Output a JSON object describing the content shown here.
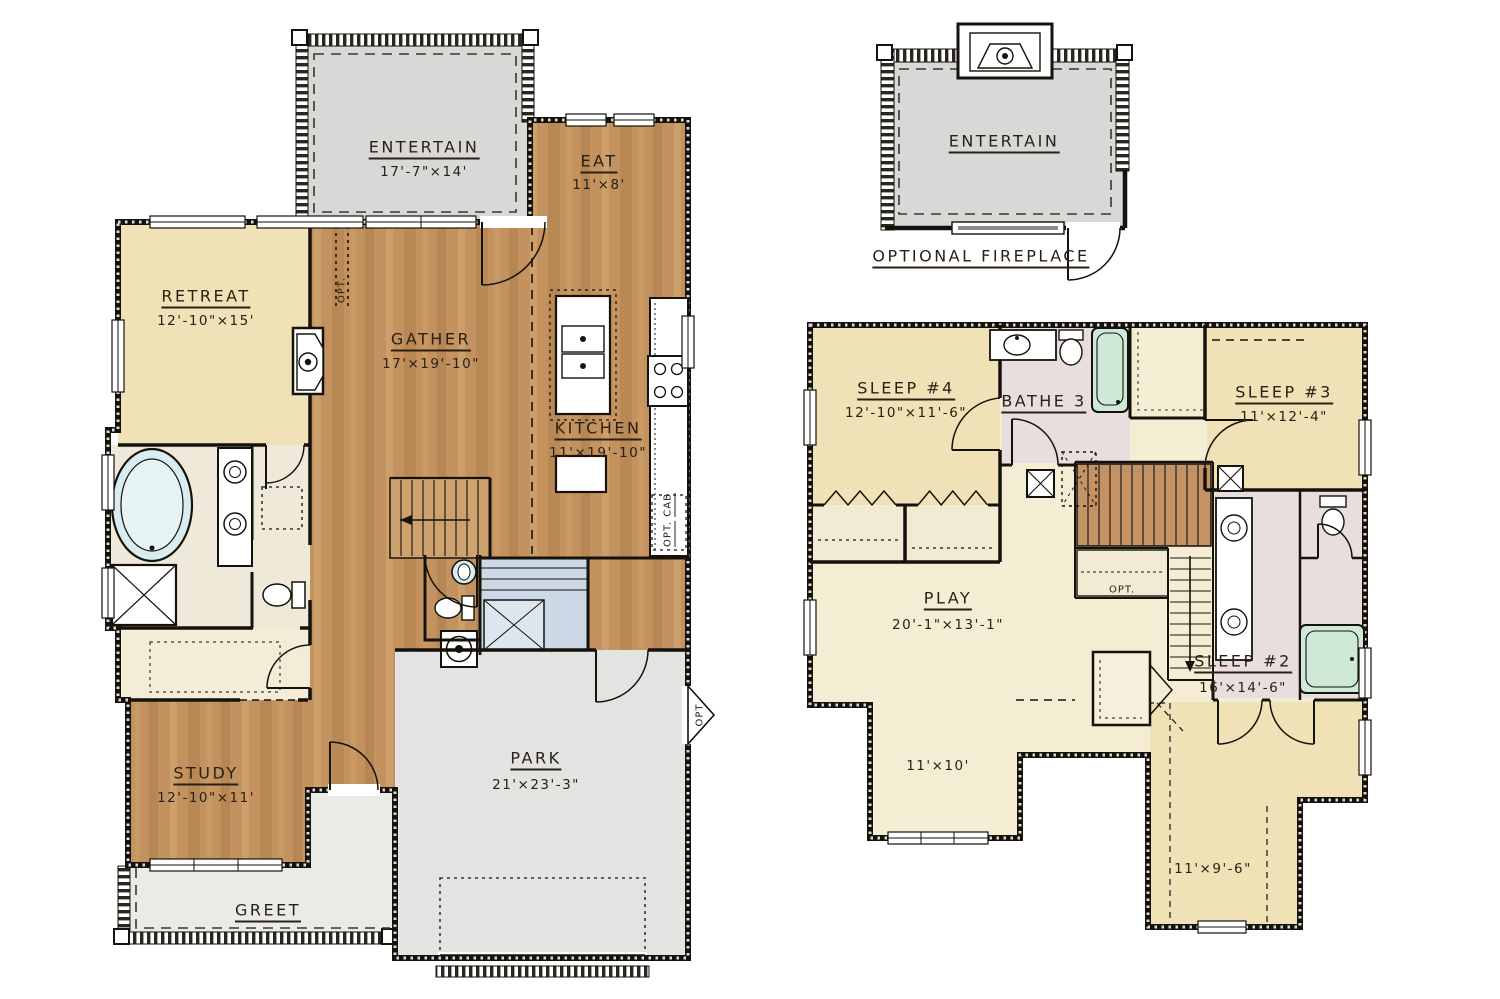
{
  "f1": {
    "entertain": {
      "name": "ENTERTAIN",
      "dims": "17'-7\"×14'"
    },
    "eat": {
      "name": "EAT",
      "dims": "11'×8'"
    },
    "retreat": {
      "name": "RETREAT",
      "dims": "12'-10\"×15'"
    },
    "gather": {
      "name": "GATHER",
      "dims": "17'×19'-10\""
    },
    "kitchen": {
      "name": "KITCHEN",
      "dims": "11'×19'-10\""
    },
    "study": {
      "name": "STUDY",
      "dims": "12'-10\"×11'"
    },
    "park": {
      "name": "PARK",
      "dims": "21'×23'-3\""
    },
    "greet": {
      "name": "GREET"
    },
    "opt_wall": "OPT.",
    "opt_cab_1": "OPT.",
    "opt_cab_2": "CAB",
    "opt_door": "OPT"
  },
  "fp": {
    "name": "ENTERTAIN",
    "caption": "OPTIONAL FIREPLACE"
  },
  "f2": {
    "sleep4": {
      "name": "SLEEP #4",
      "dims": "12'-10\"×11'-6\""
    },
    "bathe3": {
      "name": "BATHE 3"
    },
    "sleep3": {
      "name": "SLEEP #3",
      "dims": "11'×12'-4\""
    },
    "play": {
      "name": "PLAY",
      "dims": "20'-1\"×13'-1\""
    },
    "sleep2": {
      "name": "SLEEP #2",
      "dims": "16'×14'-6\""
    },
    "area_a": "11'×10'",
    "area_b": "11'×9'-6\"",
    "opt_stairs": "OPT."
  },
  "colors": {
    "wood": "#c3925e",
    "tan": "#f1e1b6",
    "cream": "#f5edd3",
    "deck_gray": "#d8d8d6",
    "garage_gray": "#e3e3e1",
    "bath_pink": "#e9dede",
    "stair_blue": "#ccd8e5",
    "tub_green": "#cfe9d8",
    "wall": "#15120c",
    "label": "#2a2013"
  }
}
